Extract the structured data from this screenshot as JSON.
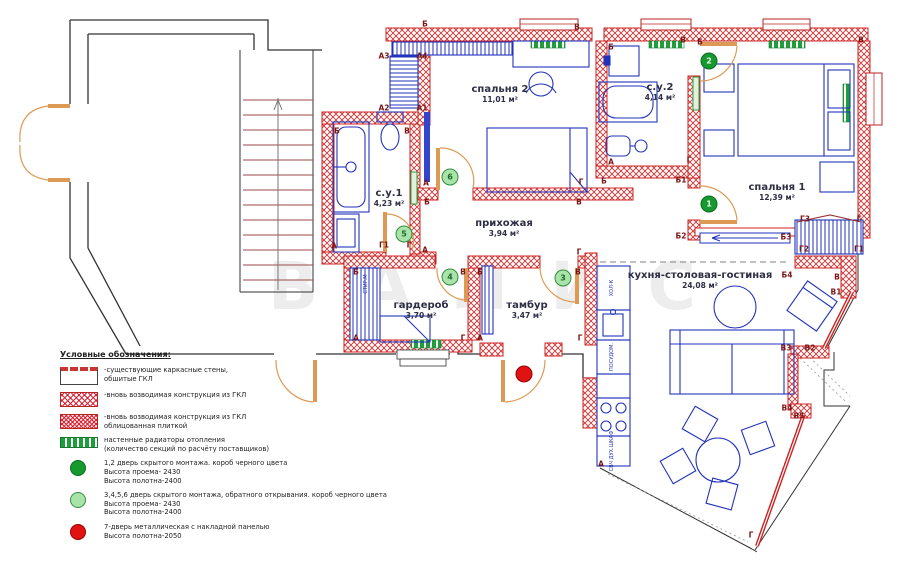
{
  "watermark": "ВАЛИС",
  "rooms": [
    {
      "name": "спальня 2",
      "area": "11,01 м²",
      "x": 500,
      "y": 84
    },
    {
      "name": "с.у.1",
      "area": "4,23 м²",
      "x": 389,
      "y": 188
    },
    {
      "name": "с.у.2",
      "area": "4,14 м²",
      "x": 660,
      "y": 82
    },
    {
      "name": "спальня 1",
      "area": "12,39 м²",
      "x": 777,
      "y": 182
    },
    {
      "name": "прихожая",
      "area": "3,94 м²",
      "x": 504,
      "y": 218
    },
    {
      "name": "гардероб",
      "area": "3,70 м²",
      "x": 421,
      "y": 300
    },
    {
      "name": "тамбур",
      "area": "3,47 м²",
      "x": 527,
      "y": 300
    },
    {
      "name": "кухня-столовая-гостиная",
      "area": "24,08 м²",
      "x": 700,
      "y": 270
    }
  ],
  "wall_markers": [
    [
      "Б",
      425,
      24
    ],
    [
      "В",
      577,
      27
    ],
    [
      "В",
      683,
      40
    ],
    [
      "Б",
      700,
      42
    ],
    [
      "В",
      861,
      40
    ],
    [
      "Б",
      611,
      47
    ],
    [
      "А3",
      384,
      56
    ],
    [
      "А4",
      422,
      56
    ],
    [
      "А2",
      384,
      108
    ],
    [
      "А1",
      422,
      108
    ],
    [
      "Б",
      337,
      131
    ],
    [
      "В",
      407,
      131
    ],
    [
      "А",
      426,
      183
    ],
    [
      "Б",
      427,
      202
    ],
    [
      "Г",
      581,
      182
    ],
    [
      "В",
      579,
      202
    ],
    [
      "А",
      611,
      162
    ],
    [
      "Г",
      689,
      160
    ],
    [
      "Б",
      604,
      181
    ],
    [
      "Б1",
      681,
      180
    ],
    [
      "А",
      334,
      246
    ],
    [
      "Г1",
      384,
      245
    ],
    [
      "Г",
      409,
      245
    ],
    [
      "А",
      425,
      250
    ],
    [
      "Г3",
      805,
      219
    ],
    [
      "Г",
      859,
      219
    ],
    [
      "Г2",
      804,
      249
    ],
    [
      "Г1",
      859,
      249
    ],
    [
      "Б2",
      681,
      236
    ],
    [
      "Б3",
      786,
      237
    ],
    [
      "Г",
      579,
      252
    ],
    [
      "Б",
      356,
      272
    ],
    [
      "В",
      463,
      272
    ],
    [
      "Б",
      480,
      272
    ],
    [
      "В",
      578,
      272
    ],
    [
      "Б4",
      787,
      275
    ],
    [
      "В",
      837,
      277
    ],
    [
      "В1",
      836,
      292
    ],
    [
      "А",
      356,
      338
    ],
    [
      "Г",
      463,
      338
    ],
    [
      "А",
      480,
      338
    ],
    [
      "Г",
      580,
      338
    ],
    [
      "В3",
      786,
      348
    ],
    [
      "В2",
      810,
      348
    ],
    [
      "В4",
      787,
      408
    ],
    [
      "В5",
      799,
      416
    ],
    [
      "А",
      601,
      464
    ],
    [
      "Г",
      751,
      535
    ]
  ],
  "door_circles": [
    {
      "num": "2",
      "x": 709,
      "y": 61,
      "kind": "dark"
    },
    {
      "num": "1",
      "x": 709,
      "y": 204,
      "kind": "dark"
    },
    {
      "num": "6",
      "x": 450,
      "y": 177,
      "kind": "light"
    },
    {
      "num": "5",
      "x": 404,
      "y": 234,
      "kind": "light"
    },
    {
      "num": "4",
      "x": 450,
      "y": 277,
      "kind": "light"
    },
    {
      "num": "3",
      "x": 563,
      "y": 278,
      "kind": "light"
    },
    {
      "num": "",
      "x": 524,
      "y": 374,
      "kind": "red"
    }
  ],
  "appliances": [
    {
      "label": "СТИР.М",
      "x": 366,
      "y": 284
    },
    {
      "label": "ХОЛ-К",
      "x": 612,
      "y": 288
    },
    {
      "label": "ПОСУДОМ.",
      "x": 612,
      "y": 357
    },
    {
      "label": "СВЧ ДУХ.ШКАФ",
      "x": 612,
      "y": 451
    }
  ],
  "legend": {
    "title": "Условные обозначения:",
    "items": [
      {
        "kind": "existing",
        "lines": [
          "-существующие каркасные стены,",
          "обшитые ГКЛ"
        ]
      },
      {
        "kind": "gkl",
        "lines": [
          "-вновь возводимая конструкция из ГКЛ"
        ]
      },
      {
        "kind": "gkl_tile",
        "lines": [
          "-вновь возводимая конструкция из ГКЛ",
          "облицованная плиткой"
        ]
      },
      {
        "kind": "radiator",
        "lines": [
          "настенные радиаторы отопления",
          "(количество секций по расчёту поставщиков)"
        ]
      },
      {
        "kind": "door_dark",
        "lines": [
          "1,2 дверь скрытого монтажа. короб черного цвета",
          "Высота проема- 2430",
          "Высота полотна-2400"
        ]
      },
      {
        "kind": "door_light",
        "lines": [
          "3,4,5,6 дверь скрытого монтажа, обратного открывания. короб черного цвета",
          "Высота проема- 2430",
          "Высота полотна-2400"
        ]
      },
      {
        "kind": "door_red",
        "lines": [
          "7-дверь металлическая с накладной панелью",
          "Высота полотна-2050"
        ]
      }
    ]
  },
  "colors": {
    "wall_red": "#cc2222",
    "furniture_blue": "#2233bb",
    "door_orange": "#dd9a55",
    "radiator_green": "#1f9e3c",
    "marker_text": "#7a1616",
    "door_dark_green": "#169a30",
    "door_light_green": "#a9e3a9",
    "door_red": "#e01212"
  }
}
